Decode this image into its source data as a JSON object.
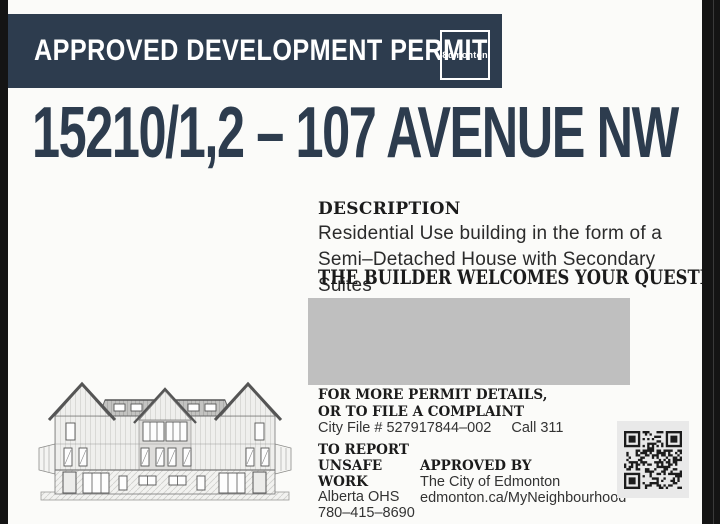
{
  "header": {
    "title": "APPROVED DEVELOPMENT PERMIT",
    "logo": "Ɛdmonton"
  },
  "address": "15210/1,2 – 107 AVENUE NW",
  "description": {
    "heading": "DESCRIPTION",
    "line1": "Residential Use building in the form of a",
    "line2": "Semi–Detached House with Secondary Suites",
    "builder_heading": "THE BUILDER WELCOMES YOUR QUESTIONS:"
  },
  "permit_details": {
    "line1": "FOR MORE PERMIT DETAILS,",
    "line2": "OR TO FILE A COMPLAINT",
    "city_file": "City File # 527917844–002",
    "call": "Call 311"
  },
  "report": {
    "heading1": "TO REPORT",
    "heading2": "UNSAFE WORK",
    "org": "Alberta OHS",
    "phone": "780–415–8690"
  },
  "approved": {
    "heading": "APPROVED BY",
    "org": "The City of Edmonton",
    "url": "edmonton.ca/MyNeighbourhood"
  },
  "icons": {
    "qr": "qr-code",
    "logo": "edmonton-city-logo"
  },
  "colors": {
    "navy": "#2d3c4e",
    "redacted_box": "#bfbfbf",
    "qr_panel": "#e9e9e9",
    "sign_background": "#fbfbf9",
    "photo_edge": "#141414"
  }
}
